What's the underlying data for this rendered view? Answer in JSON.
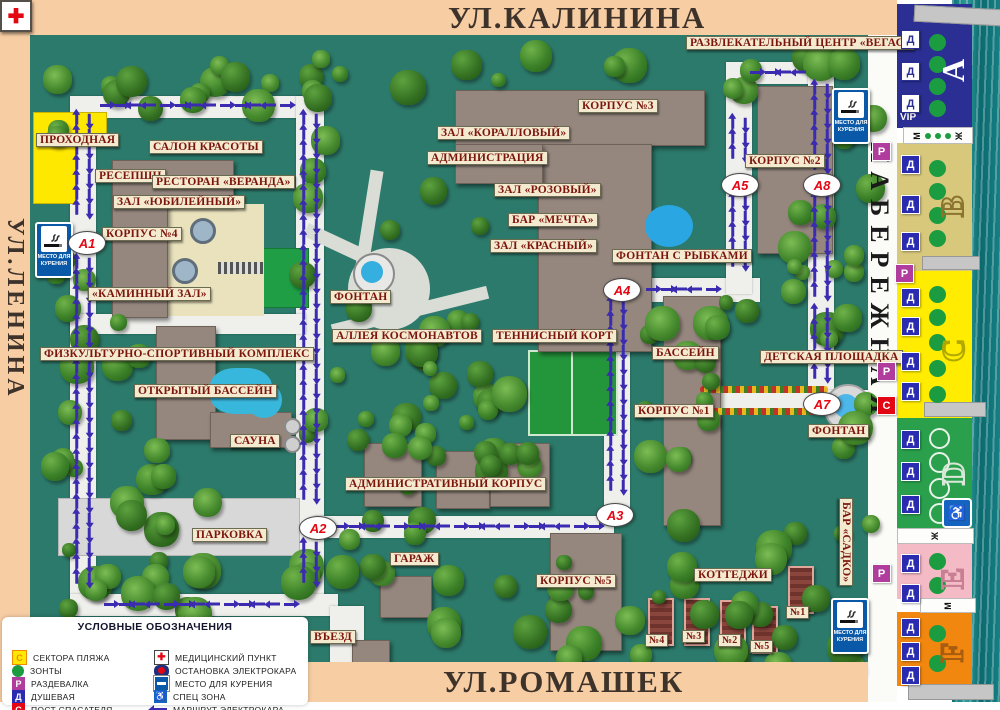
{
  "streets": {
    "top": "УЛ.КАЛИНИНА",
    "left": "УЛ.ЛЕНИНА",
    "right": "НАБЕРЕЖНАЯ",
    "bottom": "УЛ.РОМАШЕК"
  },
  "labels": [
    {
      "id": "vegas",
      "text": "РАЗВЛЕКАТЕЛЬНЫЙ ЦЕНТР «ВЕГАС»"
    },
    {
      "id": "prohodnaya",
      "text": "ПРОХОДНАЯ"
    },
    {
      "id": "salon_krasoty",
      "text": "САЛОН КРАСОТЫ"
    },
    {
      "id": "resepshn",
      "text": "РЕСЕПШН"
    },
    {
      "id": "restoran_veranda",
      "text": "РЕСТОРАН «ВЕРАНДА»"
    },
    {
      "id": "zal_yubileyny",
      "text": "ЗАЛ «ЮБИЛЕЙНЫЙ»"
    },
    {
      "id": "korpus_4",
      "text": "КОРПУС №4"
    },
    {
      "id": "kaminny_zal",
      "text": "«КАМИННЫЙ ЗАЛ»"
    },
    {
      "id": "zal_korallovy",
      "text": "ЗАЛ «КОРАЛЛОВЫЙ»"
    },
    {
      "id": "administratsiya",
      "text": "АДМИНИСТРАЦИЯ"
    },
    {
      "id": "zal_rozovy",
      "text": "ЗАЛ «РОЗОВЫЙ»"
    },
    {
      "id": "bar_mechta",
      "text": "БАР «МЕЧТА»"
    },
    {
      "id": "zal_krasny",
      "text": "ЗАЛ «КРАСНЫЙ»"
    },
    {
      "id": "korpus_3",
      "text": "КОРПУС №3"
    },
    {
      "id": "korpus_2",
      "text": "КОРПУС №2"
    },
    {
      "id": "fontan_s_rybkami",
      "text": "ФОНТАН С РЫБКАМИ"
    },
    {
      "id": "fontan_center",
      "text": "ФОНТАН"
    },
    {
      "id": "alleya_kosmonavtov",
      "text": "АЛЛЕЯ КОСМОНАВТОВ"
    },
    {
      "id": "tennisny_kort",
      "text": "ТЕННИСНЫЙ КОРТ"
    },
    {
      "id": "fizkulturno",
      "text": "ФИЗКУЛЬТУРНО-СПОРТИВНЫЙ КОМПЛЕКС"
    },
    {
      "id": "otkryty_bassein",
      "text": "ОТКРЫТЫЙ БАССЕЙН"
    },
    {
      "id": "sauna",
      "text": "САУНА"
    },
    {
      "id": "bassein",
      "text": "БАССЕЙН"
    },
    {
      "id": "detskaya_ploshchadka",
      "text": "ДЕТСКАЯ ПЛОЩАДКА"
    },
    {
      "id": "korpus_1",
      "text": "КОРПУС №1"
    },
    {
      "id": "fontan_right",
      "text": "ФОНТАН"
    },
    {
      "id": "administrativny_korpus",
      "text": "АДМИНИСТРАТИВНЫЙ КОРПУС"
    },
    {
      "id": "parkovka",
      "text": "ПАРКОВКА"
    },
    {
      "id": "garazh",
      "text": "ГАРАЖ"
    },
    {
      "id": "korpus_5",
      "text": "КОРПУС №5"
    },
    {
      "id": "kottedzhi",
      "text": "КОТТЕДЖИ"
    },
    {
      "id": "vezd",
      "text": "ВЪЕЗД"
    },
    {
      "id": "cottage_4",
      "text": "№4"
    },
    {
      "id": "cottage_3",
      "text": "№3"
    },
    {
      "id": "cottage_2",
      "text": "№2"
    },
    {
      "id": "cottage_5",
      "text": "№5"
    },
    {
      "id": "cottage_1",
      "text": "№1"
    },
    {
      "id": "bar_sadko",
      "text": "БАР «САДКО»"
    }
  ],
  "markers": [
    {
      "id": "a1",
      "label": "А1"
    },
    {
      "id": "a2",
      "label": "А2"
    },
    {
      "id": "a3",
      "label": "А3"
    },
    {
      "id": "a4",
      "label": "А4"
    },
    {
      "id": "a5",
      "label": "А5"
    },
    {
      "id": "a7",
      "label": "А7"
    },
    {
      "id": "a8",
      "label": "А8"
    }
  ],
  "smoking_sign": {
    "line1": "МЕСТО ДЛЯ",
    "line2": "КУРЕНИЯ"
  },
  "street_badges": [
    {
      "type": "Р"
    },
    {
      "type": "Р"
    },
    {
      "type": "Р"
    },
    {
      "type": "С"
    },
    {
      "type": "Р"
    }
  ],
  "beach": {
    "vip_label": "VIP",
    "shower_badge": "Д",
    "sectors": [
      {
        "letter": "А",
        "color": "#2b2f93",
        "letter_color": "#ffffff",
        "badges": 3,
        "umbrellas": 4,
        "style": "dark"
      },
      {
        "letter": "В",
        "color": "#d8c87c",
        "letter_color": "#8a7430",
        "badges": 3,
        "umbrellas": 4
      },
      {
        "letter": "С",
        "color": "#ffec00",
        "letter_color": "#b0a800",
        "badges": 4,
        "umbrellas": 5
      },
      {
        "letter": "D",
        "color": "#2aa04c",
        "letter_color": "#d8e8d8",
        "badges": 3,
        "umbrellas": 4,
        "umbrella_style": "outline",
        "has_wheelchair": true
      },
      {
        "letter": "Е",
        "color": "#f4bac5",
        "letter_color": "#c87f93",
        "badges": 2,
        "umbrellas": 2
      },
      {
        "letter": "F",
        "color": "#f1870f",
        "letter_color": "#a85c10",
        "badges": 3,
        "umbrellas": 2
      }
    ],
    "toilet_strips": [
      {
        "left": "М",
        "dots": 3,
        "right": "Ж"
      },
      {
        "left": "Ж",
        "dots": 0,
        "right": ""
      },
      {
        "left": "М",
        "dots": 0,
        "right": ""
      }
    ]
  },
  "legend": {
    "title": "УСЛОВНЫЕ ОБОЗНАЧЕНИЯ",
    "items_left": [
      {
        "icon": "sector",
        "label": "СЕКТОРА ПЛЯЖА"
      },
      {
        "icon": "umbrella",
        "label": "ЗОНТЫ"
      },
      {
        "icon": "razdevalka",
        "label": "РАЗДЕВАЛКА"
      },
      {
        "icon": "dushevaya",
        "label": "ДУШЕВАЯ"
      },
      {
        "icon": "post",
        "label": "ПОСТ СПАСАТЕЛЯ"
      }
    ],
    "items_right": [
      {
        "icon": "med",
        "label": "МЕДИЦИНСКИЙ ПУНКТ"
      },
      {
        "icon": "stop",
        "label": "ОСТАНОВКА ЭЛЕКТРОКАРА"
      },
      {
        "icon": "smoke",
        "label": "МЕСТО ДЛЯ КУРЕНИЯ"
      },
      {
        "icon": "wheel",
        "label": "СПЕЦ ЗОНА"
      },
      {
        "icon": "route",
        "label": "МАРШРУТ ЭЛЕКТРОКАРА"
      }
    ]
  },
  "colors": {
    "frame": "#f7cda4",
    "map_bg": "#2c7a6b",
    "road": "#efefec",
    "arrow": "#3a2bb0",
    "marker_text": "#e30613",
    "label_bg": "#f3ead0",
    "label_text": "#7c150c",
    "badge_r": "#b03d9e",
    "badge_s": "#e30613",
    "badge_d": "#2b2bb0",
    "umbrella": "#1c9c40",
    "water": "#0d7277"
  }
}
